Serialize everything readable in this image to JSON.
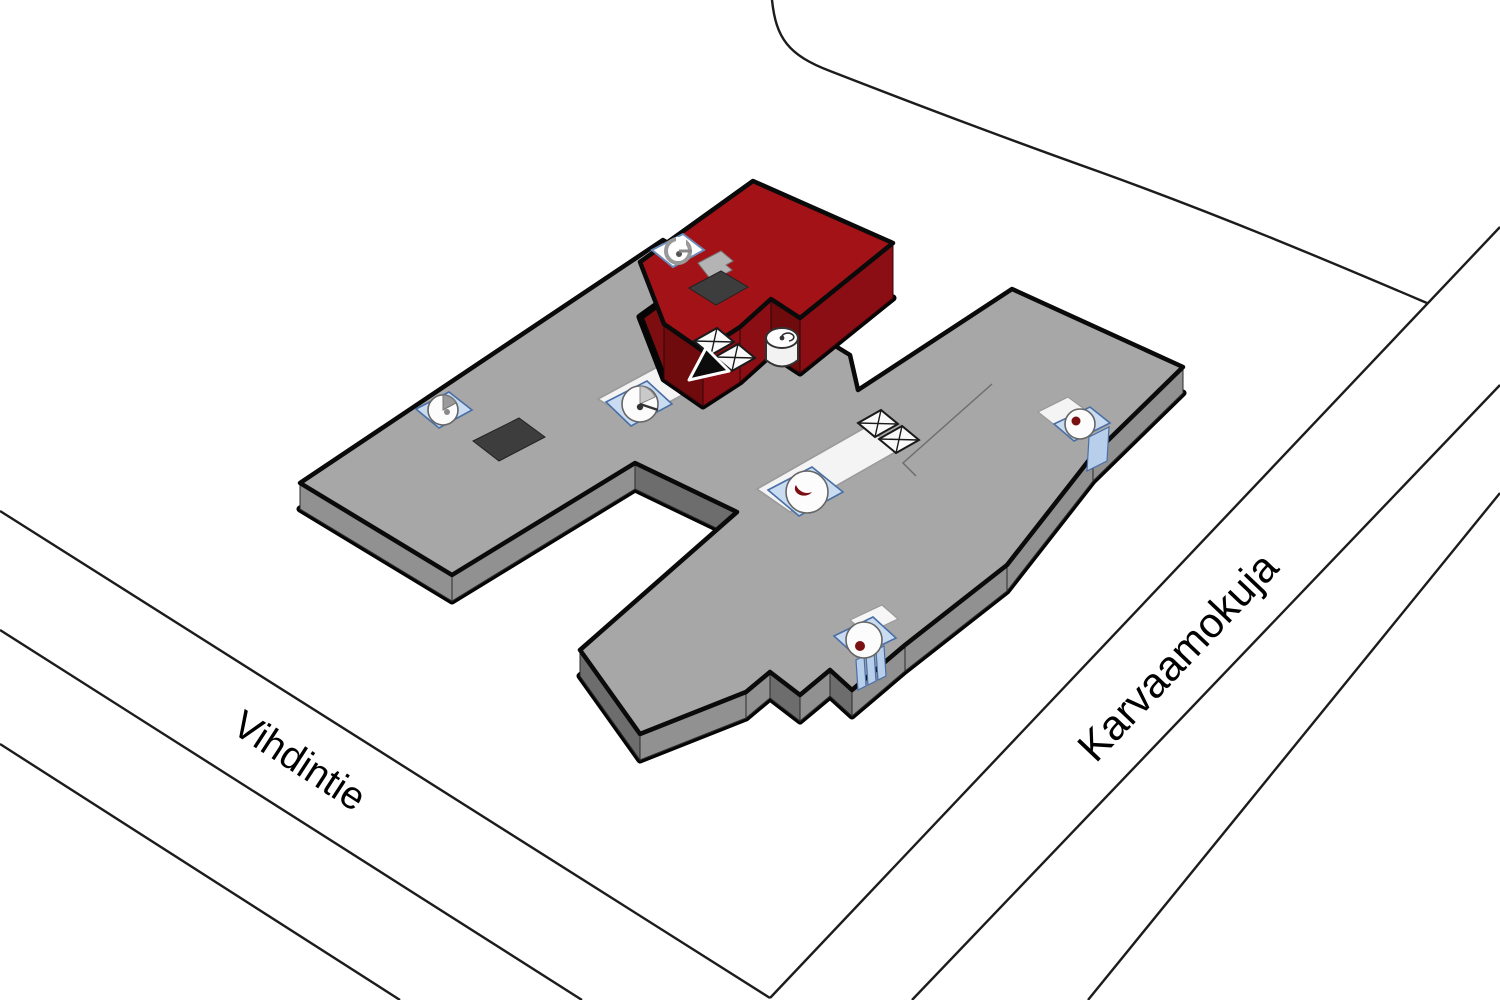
{
  "map": {
    "background": "#FFFFFF",
    "road_line_color": "#1C1C1C",
    "streets": [
      {
        "id": "vihdintie",
        "name": "Vihdintie"
      },
      {
        "id": "karvaamokuja",
        "name": "Karvaamokuja"
      }
    ],
    "building": {
      "base_color": "#A7A7A7",
      "base_bottom_color": "#7A7A7A",
      "side_color": "#919191",
      "side_dark_color": "#6D6D6D",
      "highlight_color": "#A21217",
      "highlight_bottom_color": "#7C0D11",
      "highlight_side_color": "#8A0E13",
      "highlight_side_dark_color": "#6F0A0D",
      "outline_color": "#0A0A0A",
      "corridor_color": "#F4F4F4",
      "stairs_fill": "#C9DCF2",
      "stairs_border": "#4A6FA5",
      "stairs_dot_color": "#7B1013",
      "vent_color": "#3D3D3D"
    },
    "icons": {
      "stairs": "stairs-icon",
      "elevator": "elevator-icon",
      "spiral_stairs": "spiral-stairs-icon",
      "location_arrow": "location-arrow-icon",
      "roof_vent": "roof-vent-icon"
    }
  }
}
